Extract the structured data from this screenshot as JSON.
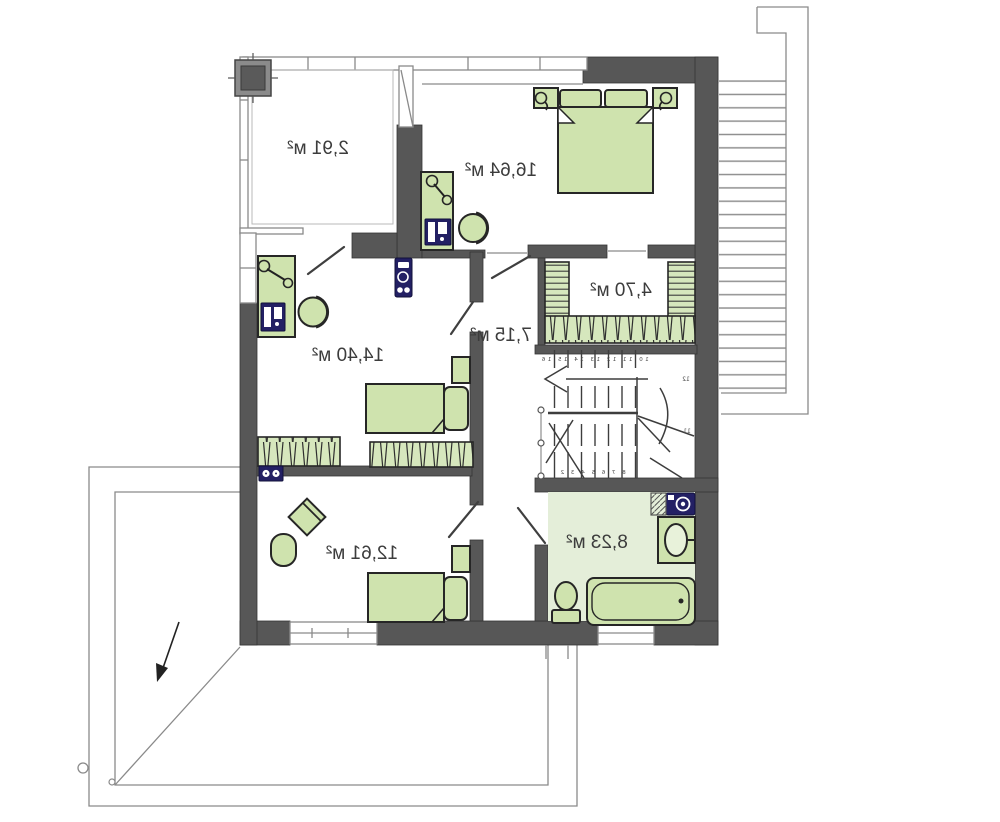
{
  "rooms": {
    "balcony": {
      "label": "2,91 м²"
    },
    "bedroom_main": {
      "label": "16,64 м²"
    },
    "wardrobe": {
      "label": "4,70 м²"
    },
    "hall": {
      "label": "7,15 м²"
    },
    "bedroom_west": {
      "label": "14,40 м²"
    },
    "bedroom_south": {
      "label": "12,61 м²"
    },
    "bathroom": {
      "label": "8,23 м²"
    }
  },
  "stairs": {
    "upper_step_numbers": "10 11 12 13 14 15 16",
    "lower_step_numbers": "8 7 6 5 4 3 2",
    "side_number_upper": "12",
    "side_number_lower": "11"
  },
  "colors": {
    "wall": "#575757",
    "furniture_green": "#cfe3ae",
    "shelf_green": "#d6e7bd",
    "bathroom_floor": "#e4eed9",
    "fixture_navy": "#232064",
    "outline": "#262626",
    "thin_line": "#8a8a8a",
    "label_text": "#3c3c3c"
  },
  "note_mirrored": "plan rendered mirror-imaged (labels read right-to-left)"
}
